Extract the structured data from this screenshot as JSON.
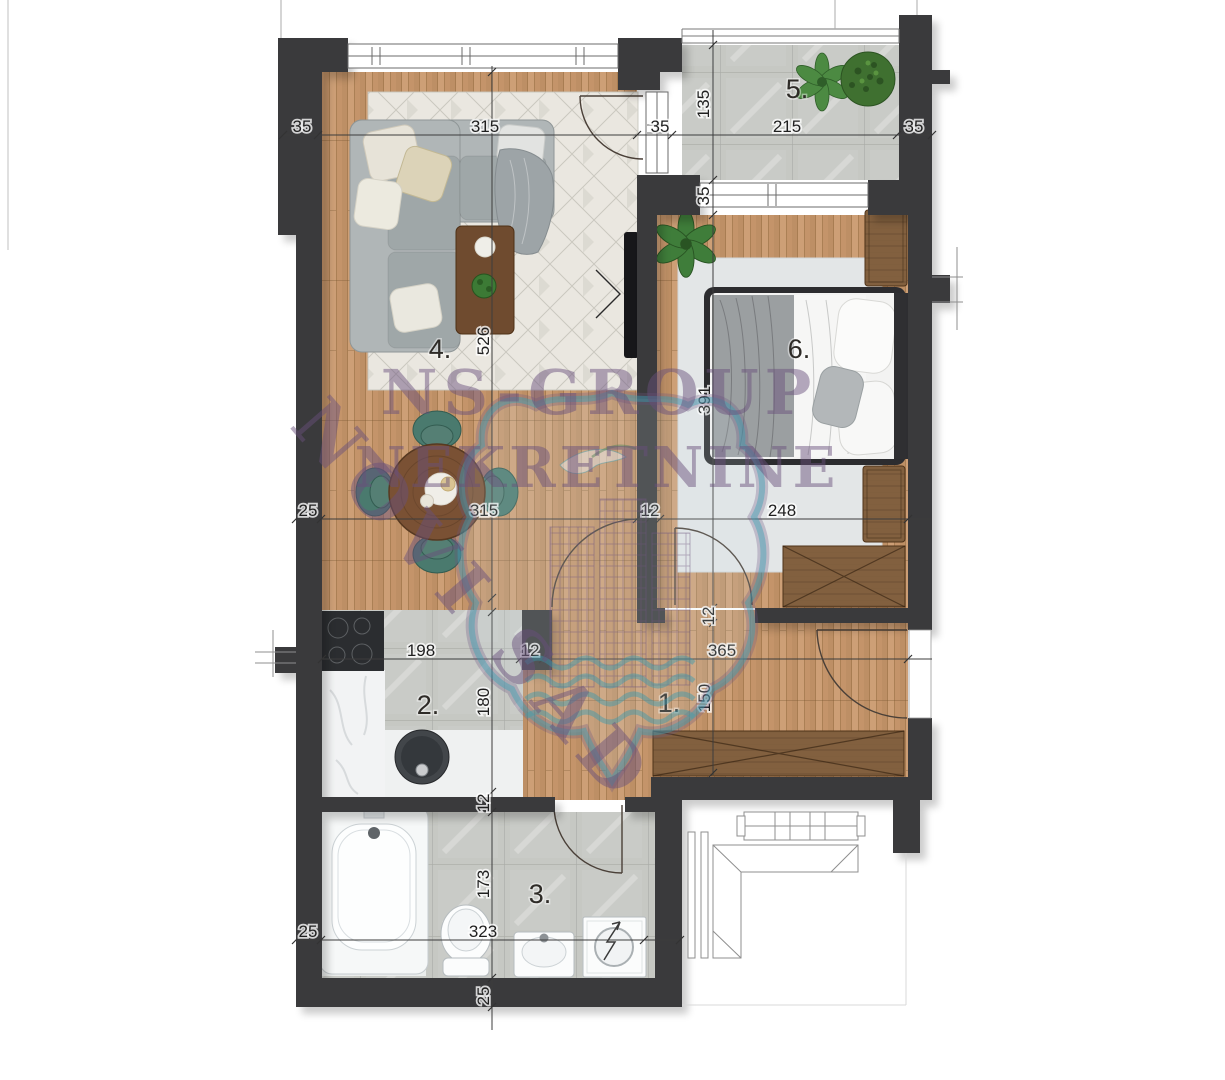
{
  "plan": {
    "watermark": {
      "line1": "NS-GROUP",
      "line2": "NEKRETNINE",
      "line3": "NOVI SAD"
    },
    "room_labels": {
      "hallway": "1.",
      "kitchen": "2.",
      "bathroom": "3.",
      "living_room": "4.",
      "terrace": "5.",
      "bedroom": "6."
    },
    "dimensions": [
      "35",
      "315",
      "35",
      "135",
      "215",
      "35",
      "35",
      "526",
      "25",
      "315",
      "12",
      "248",
      "391",
      "198",
      "12",
      "365",
      "12",
      "180",
      "150",
      "12",
      "173",
      "25",
      "323",
      "25"
    ],
    "colors": {
      "wall": "#3a3a3c",
      "wood_floor": "#c69a71",
      "tile_floor": "#c7c9c4",
      "chair_accent": "#49796d",
      "furniture_wood": "#82603f",
      "watermark_text": "#68527c",
      "watermark_shield": "#3c9bb1"
    }
  }
}
